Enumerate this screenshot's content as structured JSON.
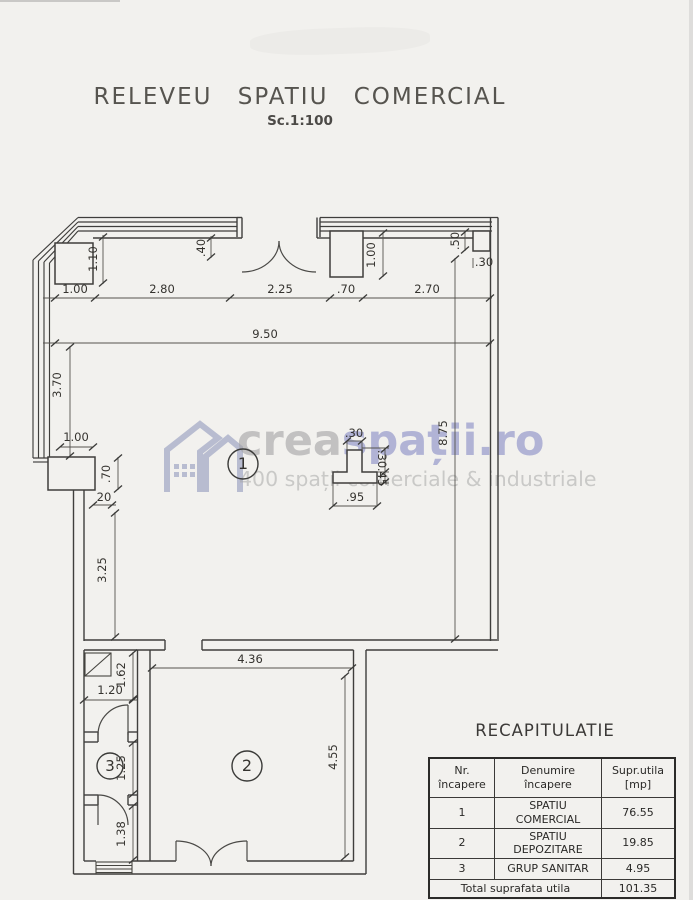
{
  "title": {
    "main": "RELEVEU SPATIU COMERCIAL",
    "scale": "Sc.1:100"
  },
  "watermark": {
    "brand_gray": "crea",
    "brand_blue": "spații.ro",
    "tagline": "400 spații comerciale & industriale"
  },
  "plan": {
    "rooms": {
      "r1": "1",
      "r2": "2",
      "r3": "3"
    },
    "dims": {
      "row1": [
        "1.00",
        "2.80",
        "2.25",
        ".70",
        "2.70"
      ],
      "total_width": "9.50",
      "d110": "1.10",
      "d40": ".40",
      "d100tr": "1.00",
      "d50": ".50",
      "d30tr": ".30",
      "d370": "3.70",
      "d100l": "1.00",
      "d70l": ".70",
      "d20": "20",
      "d325": "3.25",
      "col_top": ".30",
      "col_bottom": ".95",
      "col_r_upper": ".30",
      "col_r_lower": ".45",
      "d875": "8.75",
      "d436": "4.36",
      "d455": "4.55",
      "d162": "1.62",
      "d120": "1.20",
      "d125": "1.25",
      "d138": "1.38"
    }
  },
  "recap": {
    "title": "RECAPITULATIE",
    "columns": [
      {
        "l1": "Nr.",
        "l2": "încapere"
      },
      {
        "l1": "Denumire încapere",
        "l2": ""
      },
      {
        "l1": "Supr.utila",
        "l2": "[mp]"
      }
    ],
    "rows": [
      [
        "1",
        "SPATIU COMERCIAL",
        "76.55"
      ],
      [
        "2",
        "SPATIU DEPOZITARE",
        "19.85"
      ],
      [
        "3",
        "GRUP SANITAR",
        "4.95"
      ]
    ],
    "total_label": "Total suprafata utila",
    "total_value": "101.35"
  }
}
